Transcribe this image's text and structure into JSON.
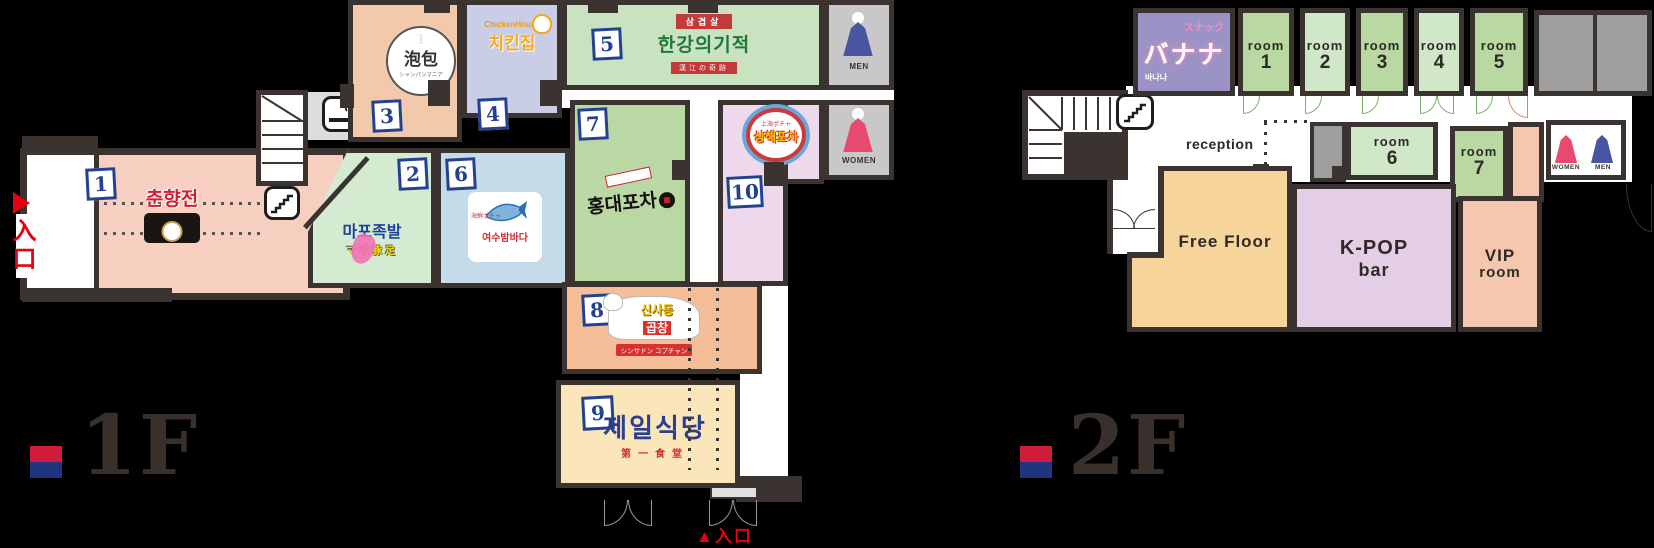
{
  "palette": {
    "background": "#000000",
    "wall": "#3a3330",
    "badge_blue": "#23418e",
    "flag_red": "#cf1c3a",
    "flag_blue": "#20357f",
    "entrance_red": "#e60012",
    "green_room_dark": "#b9d8a2",
    "green_room_light": "#d0e7c8",
    "snack_purple": "#9b93c5",
    "free_floor_orange": "#f7d49a",
    "kpop_pink": "#e4cee6",
    "vip_salmon": "#f4c7ae"
  },
  "icons": {
    "stairs": "stairs",
    "smoking": "cigarette",
    "restroom_men": "man-in-hanbok",
    "restroom_women": "woman-in-hanbok"
  },
  "floor1": {
    "label": "1F",
    "entrance_side_arrow": "▶",
    "entrance_side": "入口",
    "entrance_bottom": "▲入口",
    "restroom_men": "MEN",
    "restroom_women": "WOMEN",
    "rooms": [
      {
        "no": "1",
        "name": "춘향전",
        "color": "#f6cfc0"
      },
      {
        "no": "2",
        "name": "마포족발",
        "sub": "マポ豚足",
        "color": "#d5ebd1"
      },
      {
        "no": "3",
        "name": "泡包",
        "sub": "シャンパンマニア",
        "color": "#f2c9ab"
      },
      {
        "no": "4",
        "brand": "ChickenHouse",
        "name": "치킨집",
        "color": "#c9cde5"
      },
      {
        "no": "5",
        "band_top": "삼겹살",
        "name": "한강의기적",
        "band_bottom": "漢江の奇跡",
        "color": "#c9e2bf"
      },
      {
        "no": "6",
        "sub": "海鮮ポチャ",
        "name": "여수밤바다",
        "color": "#c5dbe9"
      },
      {
        "no": "7",
        "name": "홍대포차",
        "color": "#b9d8a4"
      },
      {
        "no": "8",
        "name_top": "신사동",
        "name_bottom": "곱창",
        "band": "シンサドン コプチャン",
        "color": "#f4be98"
      },
      {
        "no": "9",
        "name": "제일식당",
        "sub": "第一食堂",
        "color": "#fae6b9"
      },
      {
        "no": "10",
        "top": "上海ポチャ",
        "name": "상해포차",
        "color": "#eed9ec"
      }
    ]
  },
  "floor2": {
    "label": "2F",
    "snack_type": "スナック",
    "snack_name": "バナナ",
    "snack_sub": "바나나",
    "reception": "reception",
    "rooms_top": [
      {
        "label": "room",
        "num": "1"
      },
      {
        "label": "room",
        "num": "2"
      },
      {
        "label": "room",
        "num": "3"
      },
      {
        "label": "room",
        "num": "4"
      },
      {
        "label": "room",
        "num": "5"
      }
    ],
    "room6": {
      "label": "room",
      "num": "6"
    },
    "room7": {
      "label": "room",
      "num": "7"
    },
    "free_floor": "Free Floor",
    "kpop_line1": "K-POP",
    "kpop_line2": "bar",
    "vip_line1": "VIP",
    "vip_line2": "room",
    "restroom_women": "WOMEN",
    "restroom_men": "MEN"
  }
}
